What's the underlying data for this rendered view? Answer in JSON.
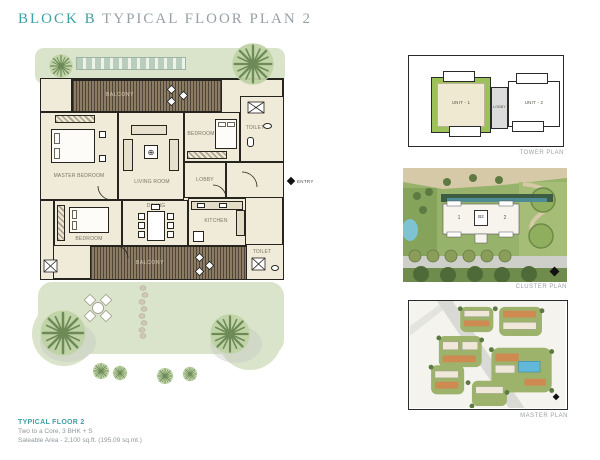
{
  "title": {
    "block": "BLOCK B",
    "rest": "TYPICAL FLOOR PLAN 2"
  },
  "floor_plan": {
    "rooms": {
      "balcony_top": "BALCONY",
      "bedroom_top": "BEDROOM",
      "toilet_top": "TOILET",
      "master_bedroom": "MASTER BEDROOM",
      "living": "LIVING ROOM",
      "lobby": "LOBBY",
      "dining": "DINING",
      "kitchen": "KITCHEN",
      "bedroom_bottom": "BEDROOM",
      "toilet_bottom": "TOILET",
      "balcony_bottom": "BALCONY",
      "entry": "ENTRY"
    }
  },
  "tower_plan": {
    "unit1": "UNIT - 1",
    "lobby": "LOBBY",
    "unit2": "UNIT - 2",
    "caption": "TOWER PLAN"
  },
  "cluster_plan": {
    "unit1": "1",
    "block": "B2",
    "unit2": "2",
    "caption": "CLUSTER PLAN"
  },
  "master_plan": {
    "caption": "MASTER PLAN"
  },
  "footer": {
    "line1": "TYPICAL FLOOR 2",
    "line2": "Two to a Core, 3 BHK + S",
    "line3": "Saleable Area - 2,100 sq.ft. (195.09 sq.mt.)"
  },
  "colors": {
    "accent": "#3FA0A6",
    "muted_text": "#8F979C",
    "landscape_green": "#D9E4CB",
    "tower_unit_green": "#9CC158"
  }
}
